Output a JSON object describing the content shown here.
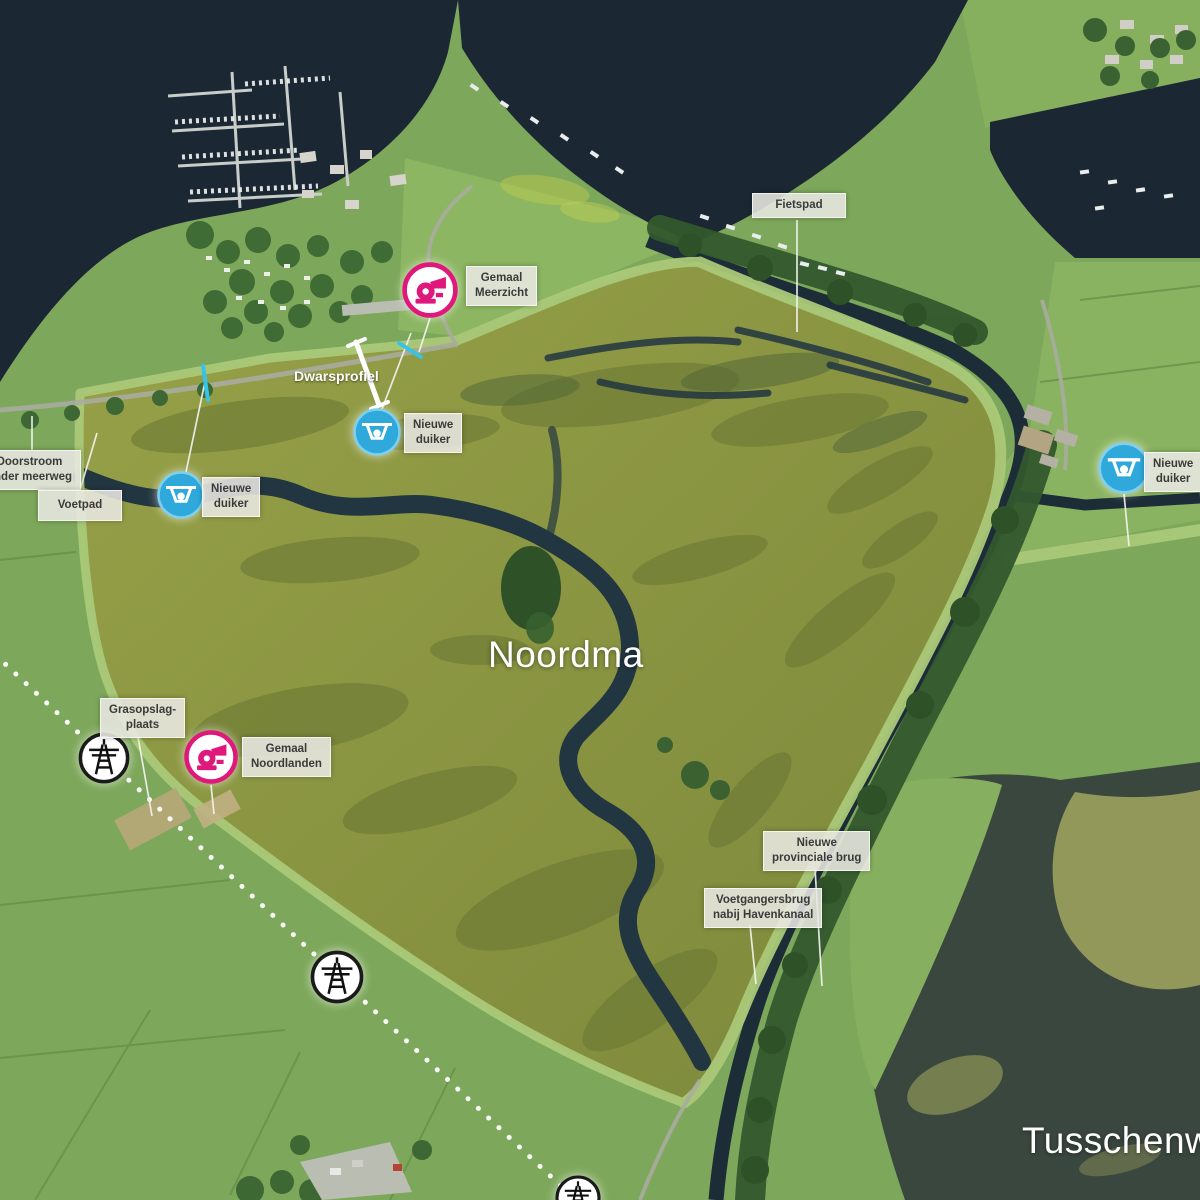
{
  "area_labels": {
    "noordma": "Noordma",
    "tusschenwater": "Tusschenwater"
  },
  "callouts": [
    {
      "id": "fietspad",
      "lines": [
        "Fietspad"
      ]
    },
    {
      "id": "gemaal-meerzicht",
      "lines": [
        "Gemaal",
        "Meerzicht"
      ],
      "marker": "gemaal-pump-icon"
    },
    {
      "id": "dwarsprofiel",
      "lines": [
        "Dwarsprofiel"
      ]
    },
    {
      "id": "nieuwe-duiker-noord",
      "lines": [
        "Nieuwe",
        "duiker"
      ],
      "marker": "duiker-culvert-icon"
    },
    {
      "id": "doorstroom-onder-meerweg",
      "lines": [
        "Doorstroom",
        "onder meerweg"
      ]
    },
    {
      "id": "voetpad",
      "lines": [
        "Voetpad"
      ]
    },
    {
      "id": "nieuwe-duiker-west",
      "lines": [
        "Nieuwe",
        "duiker"
      ],
      "marker": "duiker-culvert-icon"
    },
    {
      "id": "nieuwe-duiker-oost",
      "lines": [
        "Nieuwe",
        "duiker"
      ],
      "marker": "duiker-culvert-icon"
    },
    {
      "id": "grasopslag-plaats",
      "lines": [
        "Grasopslag-",
        "plaats"
      ]
    },
    {
      "id": "gemaal-noordlanden",
      "lines": [
        "Gemaal",
        "Noordlanden"
      ],
      "marker": "gemaal-pump-icon"
    },
    {
      "id": "nieuwe-provinciale-brug",
      "lines": [
        "Nieuwe",
        "provinciale brug"
      ]
    },
    {
      "id": "voetgangersbrug-havenkanaal",
      "lines": [
        "Voetgangersbrug",
        "nabij Havenkanaal"
      ]
    }
  ],
  "icons": {
    "gemaal": "pump-icon",
    "duiker": "culvert-weir-icon",
    "pylon": "power-pylon-icon"
  },
  "colors": {
    "gemaal_pink": "#e0187c",
    "duiker_blue": "#2fa8dc",
    "cyan_mark": "#35c4e8",
    "label_background": "#e9e8e2",
    "label_text": "#3a3a3a",
    "water_dark": "#1b2733",
    "lake_southeast": "#3a473f",
    "wetland_olive": "#8f9a43",
    "field_green": "#7da75a",
    "dike_light_green": "#aac979",
    "powerline_dotted": "#ffffff"
  }
}
